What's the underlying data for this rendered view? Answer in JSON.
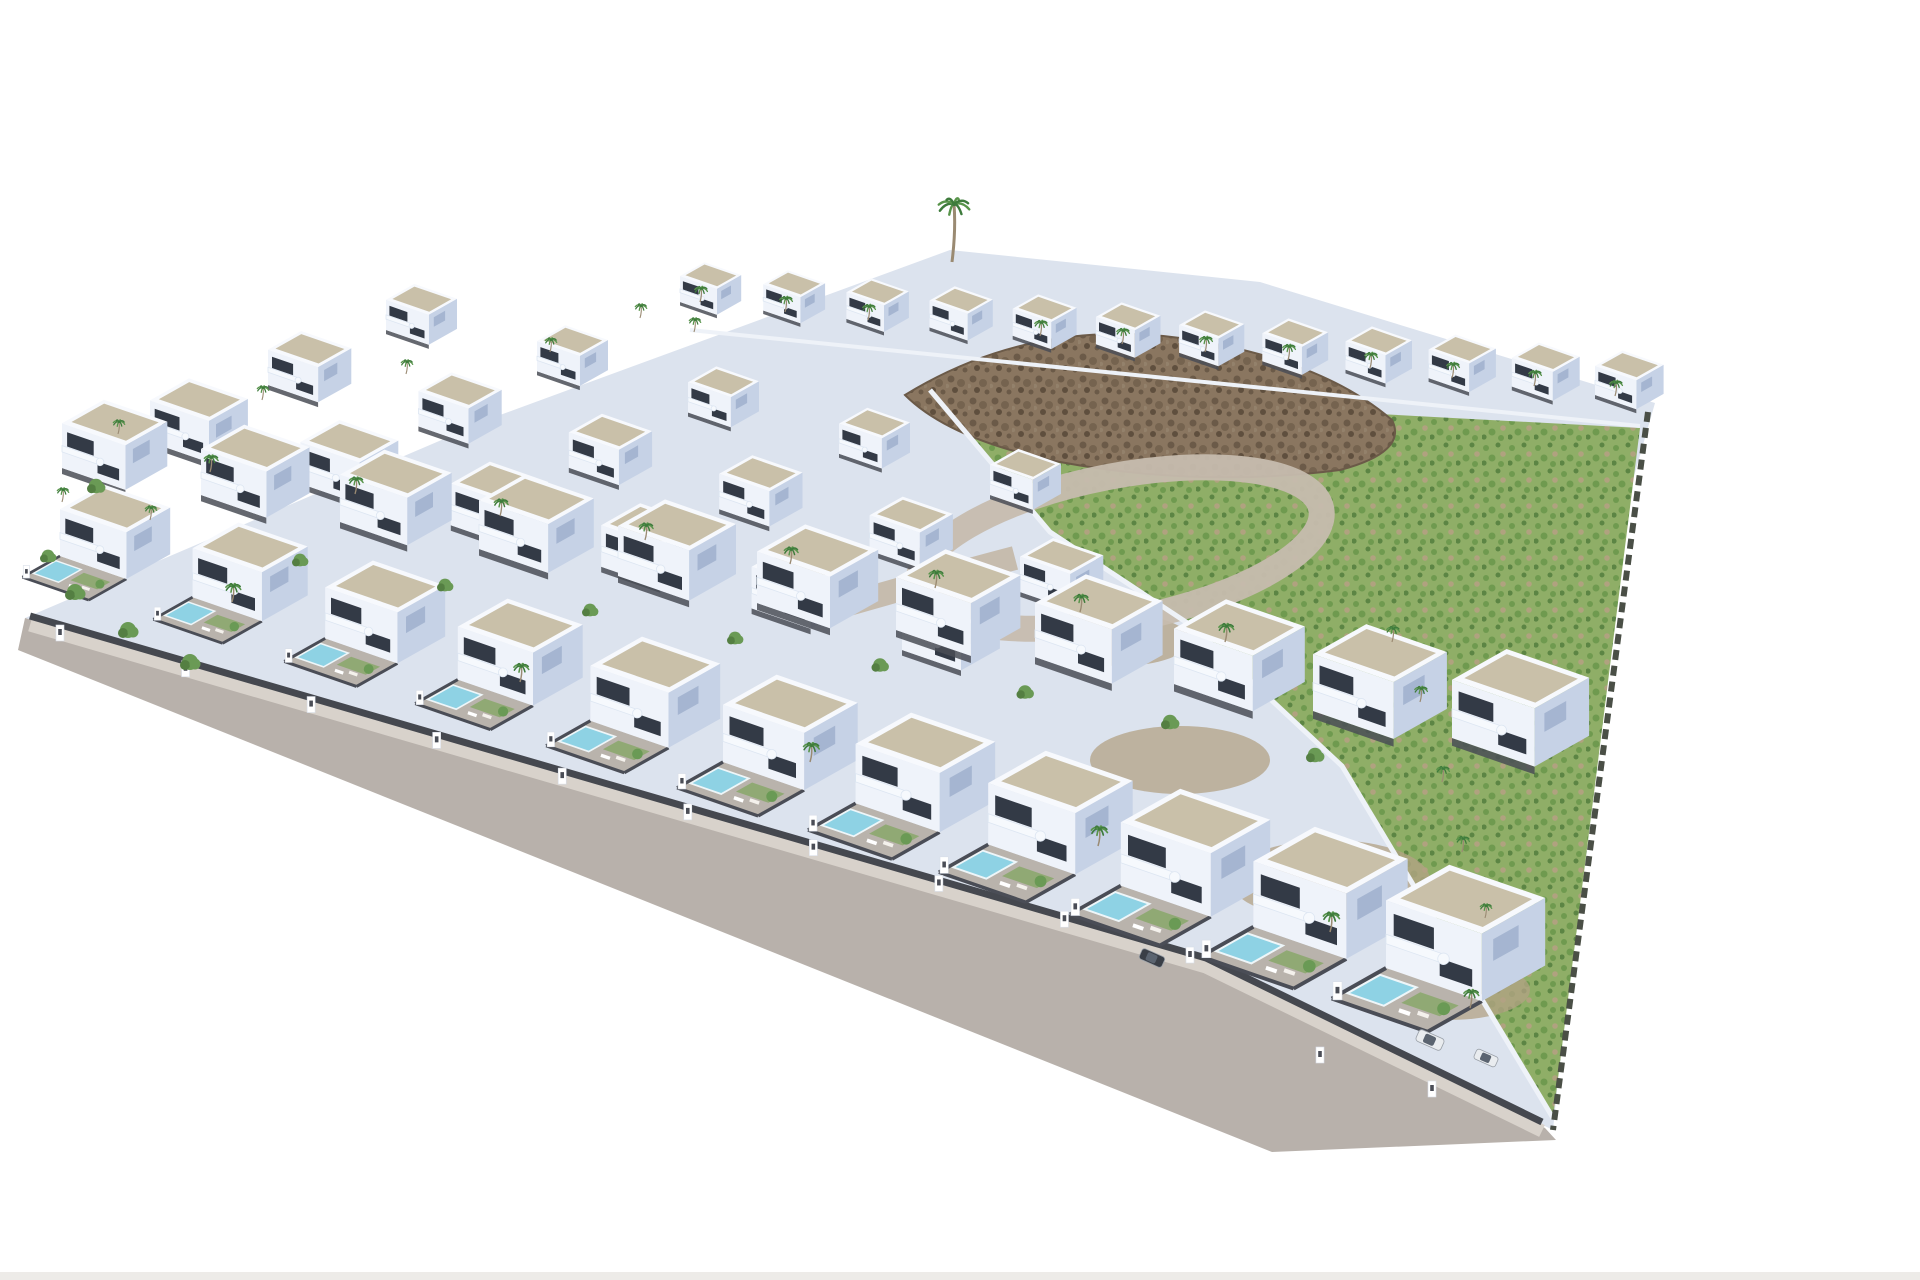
{
  "scene": {
    "description": "Aerial 3D architectural render of a residential development: rows of white modern villas with flat gravel roof decks and curved balconies, front gardens with turquoise private pools, palm trees, a grey perimeter road along the lower left edge, a green hillside plot with a brown rocky ridge on the right, and two parked cars near the bottom right, all on a plain white background.",
    "colors": {
      "background": "#ffffff",
      "platform": "#dce3ee",
      "road": "#b8b1ab",
      "sidewalk": "#d8d2cb",
      "curb_wall": "#45484f",
      "villa_front": "#eff3fa",
      "villa_side": "#c6d2e6",
      "roof": "#c9c0a9",
      "roof_edge": "#f7f9fd",
      "window": "#333a46",
      "side_window": "#9fb0cd",
      "balcony": "#f6f9fd",
      "balcony_line": "#dde6f2",
      "fence": "#4a4d56",
      "patio": "#b9b3ac",
      "pool": "#8ed2e4",
      "pool_edge": "#eef6f9",
      "lawn": "#7fa55c",
      "field_base": "#8fae67",
      "field_dots1": "#6f9a4f",
      "field_dots2": "#5c8544",
      "field_dots3": "#b0a27f",
      "rock_base": "#8a7660",
      "rock_dark": "#6b5a48",
      "rock_mid": "#75634f",
      "rock_deep": "#5f4f3e",
      "rock_light": "#93816b",
      "dirt": "#b3a284",
      "ring_road": "#c6bcae",
      "wall_white": "#eef2f8",
      "hedge_dark": "#4a4f46",
      "trunk": "#9a8a72",
      "palm_green": "#3e7b3c",
      "palm_light": "#58944a",
      "tree_green": "#6a9a55",
      "tree_dark": "#547f42",
      "car_white": "#e9ecef",
      "car_dark": "#3a3f47",
      "car_glass": "#5b6470",
      "pillar_white": "#ffffff",
      "bottom_strip": "#edebe8"
    },
    "site": {
      "platform": [
        [
          25,
          618
        ],
        [
          500,
          415
        ],
        [
          950,
          250
        ],
        [
          1260,
          282
        ],
        [
          1655,
          403
        ],
        [
          1610,
          560
        ],
        [
          1553,
          1130
        ],
        [
          1208,
          962
        ]
      ],
      "road": [
        [
          25,
          618
        ],
        [
          1208,
          962
        ],
        [
          1545,
          1128
        ],
        [
          1556,
          1140
        ],
        [
          1272,
          1152
        ],
        [
          18,
          650
        ]
      ],
      "curb_path": "M 30 616 L 1206 958 L 1542 1122",
      "field": [
        [
          930,
          390
        ],
        [
          1640,
          428
        ],
        [
          1553,
          1118
        ],
        [
          1342,
          766
        ],
        [
          1192,
          626
        ],
        [
          1050,
          532
        ]
      ],
      "ridge": "M 905 395 Q 1030 318 1180 338 Q 1320 358 1392 420 Q 1408 452 1340 470 Q 1200 488 1060 462 Q 950 440 905 395 Z",
      "field_wall": "M 930 390 L 1050 532 L 1192 626 L 1342 766 L 1553 1118",
      "top_wall": "M 690 330 L 1640 426",
      "hedge_right": "M 1648 412 L 1553 1130",
      "dirt_patches": [
        [
          1180,
          760,
          90,
          34
        ],
        [
          1330,
          880,
          100,
          40
        ],
        [
          1450,
          990,
          80,
          30
        ],
        [
          1120,
          640,
          70,
          26
        ]
      ],
      "ring": {
        "cx": 1120,
        "cy": 548,
        "rx": 205,
        "ry": 72,
        "rot": -11,
        "width": 26
      },
      "ring_spur": "M 845 605 Q 950 575 1015 558",
      "bottom_strip_y": 1272
    },
    "villa_bands": [
      {
        "name": "back-row",
        "x1": 680,
        "y1": 302,
        "x2": 1595,
        "y2": 395,
        "n": 12,
        "s1": 0.5,
        "s2": 0.56,
        "garden": false
      },
      {
        "name": "upper-terrace-row-3",
        "x1": 386,
        "y1": 330,
        "x2": 990,
        "y2": 495,
        "n": 5,
        "s1": 0.58,
        "s2": 0.58,
        "garden": false
      },
      {
        "name": "upper-terrace-row-2",
        "x1": 268,
        "y1": 385,
        "x2": 1020,
        "y2": 592,
        "n": 6,
        "s1": 0.68,
        "s2": 0.68,
        "garden": false
      },
      {
        "name": "upper-terrace-row-1",
        "x1": 150,
        "y1": 442,
        "x2": 902,
        "y2": 650,
        "n": 6,
        "s1": 0.8,
        "s2": 0.8,
        "garden": false
      },
      {
        "name": "middle-row",
        "x1": 62,
        "y1": 468,
        "x2": 1452,
        "y2": 738,
        "n": 11,
        "s1": 0.86,
        "s2": 1.12,
        "garden": false
      },
      {
        "name": "front-row",
        "x1": 60,
        "y1": 556,
        "x2": 1386,
        "y2": 968,
        "n": 11,
        "s1": 0.9,
        "s2": 1.3,
        "garden": true
      }
    ],
    "apex_palm": [
      952,
      262
    ],
    "palms": [
      [
        700,
        302,
        0.55
      ],
      [
        785,
        312,
        0.55
      ],
      [
        868,
        320,
        0.55
      ],
      [
        1040,
        336,
        0.55
      ],
      [
        1122,
        344,
        0.55
      ],
      [
        1205,
        352,
        0.55
      ],
      [
        1288,
        360,
        0.55
      ],
      [
        1370,
        368,
        0.55
      ],
      [
        1452,
        378,
        0.55
      ],
      [
        1534,
        386,
        0.55
      ],
      [
        1615,
        396,
        0.55
      ],
      [
        640,
        318,
        0.5
      ],
      [
        118,
        434,
        0.5
      ],
      [
        262,
        400,
        0.5
      ],
      [
        406,
        374,
        0.5
      ],
      [
        550,
        352,
        0.5
      ],
      [
        694,
        332,
        0.5
      ],
      [
        210,
        472,
        0.6
      ],
      [
        355,
        494,
        0.6
      ],
      [
        500,
        516,
        0.6
      ],
      [
        645,
        540,
        0.6
      ],
      [
        790,
        564,
        0.6
      ],
      [
        935,
        588,
        0.62
      ],
      [
        1080,
        612,
        0.62
      ],
      [
        1225,
        642,
        0.65
      ],
      [
        1392,
        642,
        0.55
      ],
      [
        1420,
        702,
        0.55
      ],
      [
        1442,
        782,
        0.55
      ],
      [
        1462,
        852,
        0.55
      ],
      [
        1485,
        918,
        0.5
      ],
      [
        232,
        602,
        0.65
      ],
      [
        520,
        682,
        0.65
      ],
      [
        810,
        762,
        0.68
      ],
      [
        1098,
        846,
        0.7
      ],
      [
        1330,
        932,
        0.7
      ],
      [
        1470,
        1008,
        0.65
      ],
      [
        62,
        502,
        0.5
      ],
      [
        150,
        520,
        0.5
      ]
    ],
    "trees": [
      [
        75,
        592,
        1
      ],
      [
        128,
        630,
        1
      ],
      [
        190,
        662,
        1
      ],
      [
        48,
        556,
        0.8
      ],
      [
        96,
        486,
        0.9
      ],
      [
        300,
        560,
        0.8
      ],
      [
        445,
        585,
        0.8
      ],
      [
        590,
        610,
        0.8
      ],
      [
        735,
        638,
        0.8
      ],
      [
        880,
        665,
        0.85
      ],
      [
        1025,
        692,
        0.85
      ],
      [
        1170,
        722,
        0.9
      ],
      [
        1315,
        755,
        0.9
      ]
    ],
    "pillars": {
      "x1": 60,
      "y1": 640,
      "x2": 1190,
      "y2": 962,
      "n": 10,
      "extra": [
        [
          1320,
          1062
        ],
        [
          1432,
          1096
        ]
      ]
    },
    "cars": [
      {
        "x": 1152,
        "y": 958,
        "s": 0.95,
        "rot": 24,
        "fill": "car_dark"
      },
      {
        "x": 1430,
        "y": 1040,
        "s": 1.05,
        "rot": 24,
        "fill": "car_white"
      },
      {
        "x": 1486,
        "y": 1058,
        "s": 0.9,
        "rot": 24,
        "fill": "car_white"
      }
    ]
  }
}
